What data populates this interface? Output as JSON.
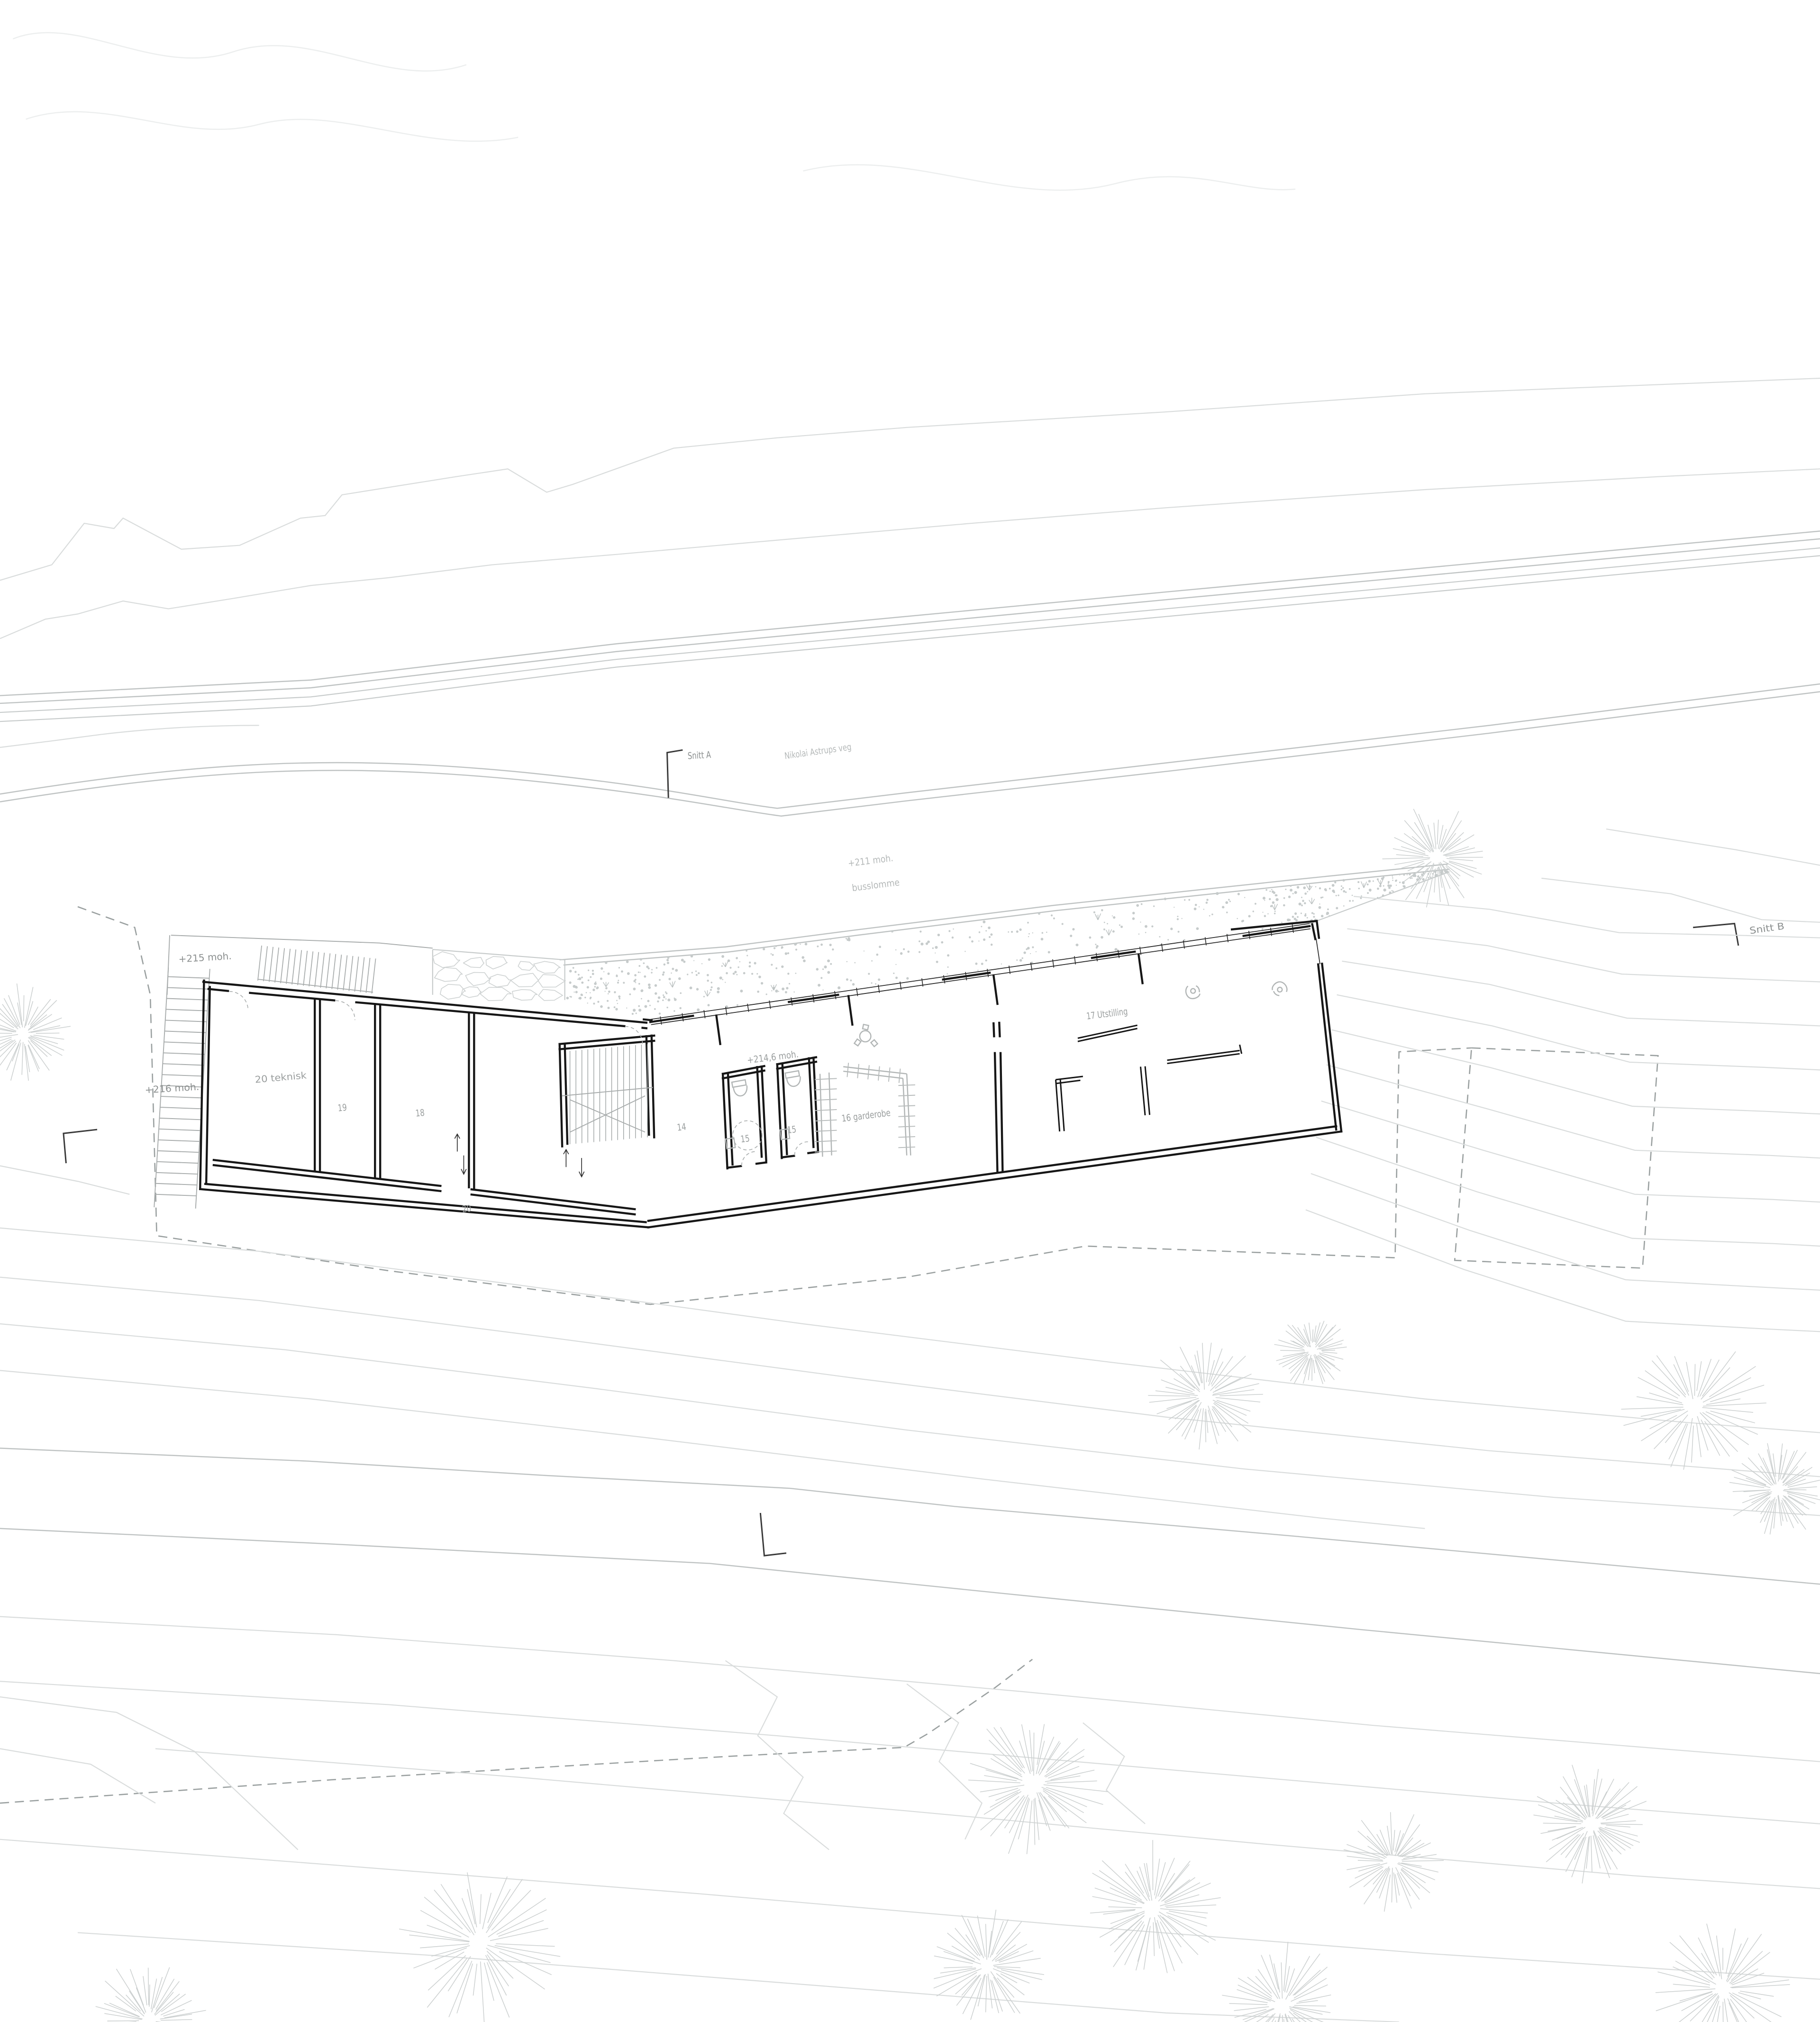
{
  "drawing_title": "Site plan - underetasje",
  "labels": {
    "snitt_a": "Snitt A",
    "snitt_b": "Snitt B",
    "road_name": "Nikolai Astrups veg",
    "elev_211": "+211 moh.",
    "busslomme": "busslomme",
    "elev_215": "+215 moh.",
    "elev_216": "+216 moh.",
    "elev_214_6": "+214,6 moh.",
    "room_20_teknisk": "20 teknisk",
    "room_19": "19",
    "room_18": "18",
    "room_14": "14",
    "room_15_a": "15",
    "room_15_b": "15",
    "room_16_garderobe": "16 garderobe",
    "room_17_utstilling": "17 Utstilling",
    "room_20": "20"
  },
  "colors": {
    "paper": "#ffffff",
    "wall": "#161616",
    "site_line": "#bfc3c3",
    "contour": "#d9dcdc",
    "label_dark": "#8b8f8f",
    "label_light": "#b4b8b8",
    "stipple": "#c6cbcb",
    "tree": "#cbcfcf",
    "dashed_boundary": "#9aa0a0"
  },
  "trees": [
    [
      1109,
      662,
      42
    ],
    [
      18,
      798,
      40
    ],
    [
      930,
      1078,
      46
    ],
    [
      1013,
      1043,
      30
    ],
    [
      1308,
      1086,
      58
    ],
    [
      1372,
      1150,
      40
    ],
    [
      798,
      1377,
      58
    ],
    [
      890,
      1473,
      55
    ],
    [
      1228,
      1408,
      48
    ],
    [
      1075,
      1437,
      40
    ],
    [
      370,
      1500,
      65
    ],
    [
      115,
      1560,
      48
    ],
    [
      990,
      1548,
      50
    ],
    [
      1330,
      1535,
      55
    ],
    [
      762,
      1518,
      46
    ]
  ],
  "stipple_band": {
    "top_edge": [
      [
        436,
        745
      ],
      [
        562,
        735
      ],
      [
        662,
        722
      ],
      [
        815,
        703
      ],
      [
        1002,
        683
      ],
      [
        1119,
        671
      ]
    ],
    "bottom_edge": [
      [
        436,
        770
      ],
      [
        502,
        787
      ],
      [
        1011,
        713
      ],
      [
        1119,
        673
      ]
    ],
    "dot_count": 560
  }
}
